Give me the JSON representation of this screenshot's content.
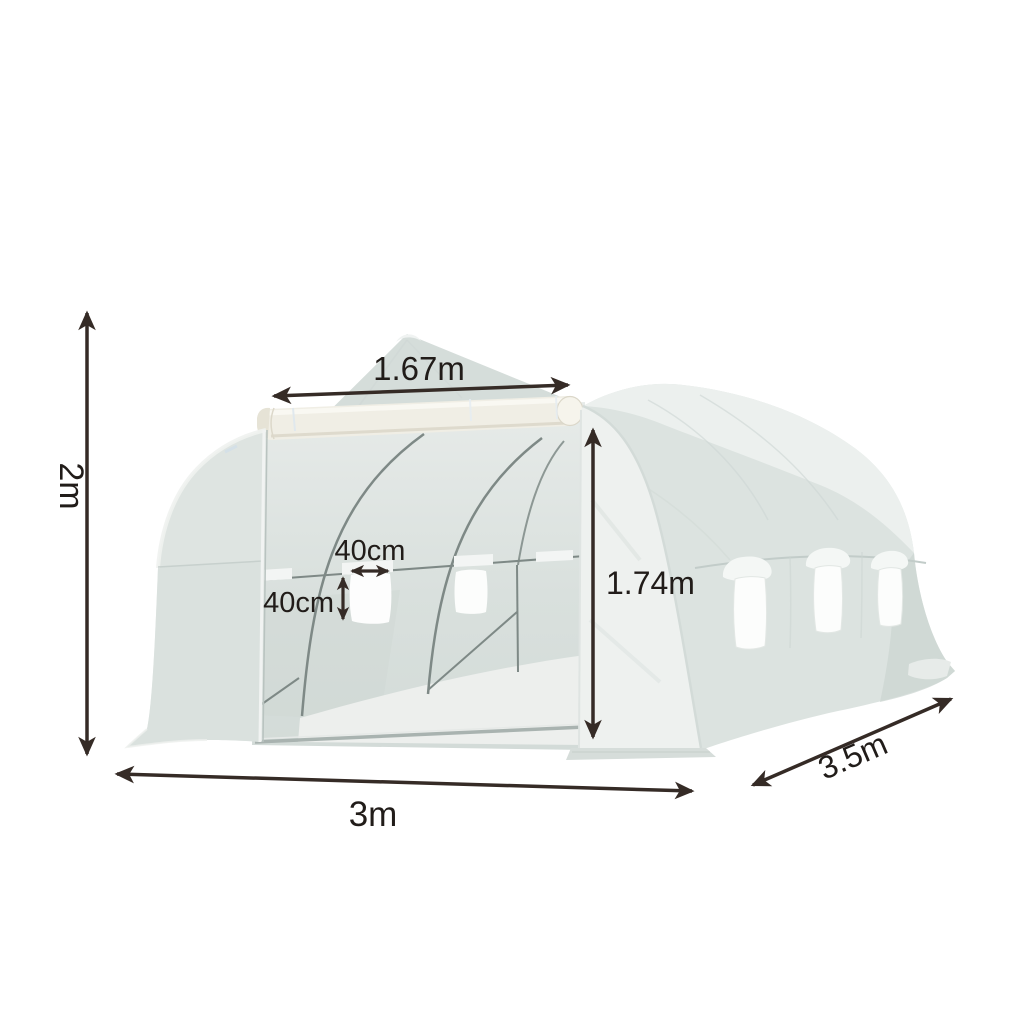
{
  "diagram": {
    "subject": "walk-in polytunnel greenhouse with dimension arrows"
  },
  "dimensions": {
    "overall_height": "2m",
    "front_width": "3m",
    "depth": "3.5m",
    "roof_ridge_width": "1.67m",
    "door_height": "1.74m",
    "window_width": "40cm",
    "window_height": "40cm"
  },
  "colors": {
    "background": "#ffffff",
    "arrow": "#352b26",
    "label_text": "#211c19",
    "tarp_base": "#dce3e0",
    "tarp_highlight": "#ecf0ee",
    "tarp_shadow": "#ccd5d2",
    "gable": "#d5ddda",
    "frame": "#7e8986",
    "door_roll": "#f0eee5",
    "window_mesh": "#fcfdfc"
  }
}
